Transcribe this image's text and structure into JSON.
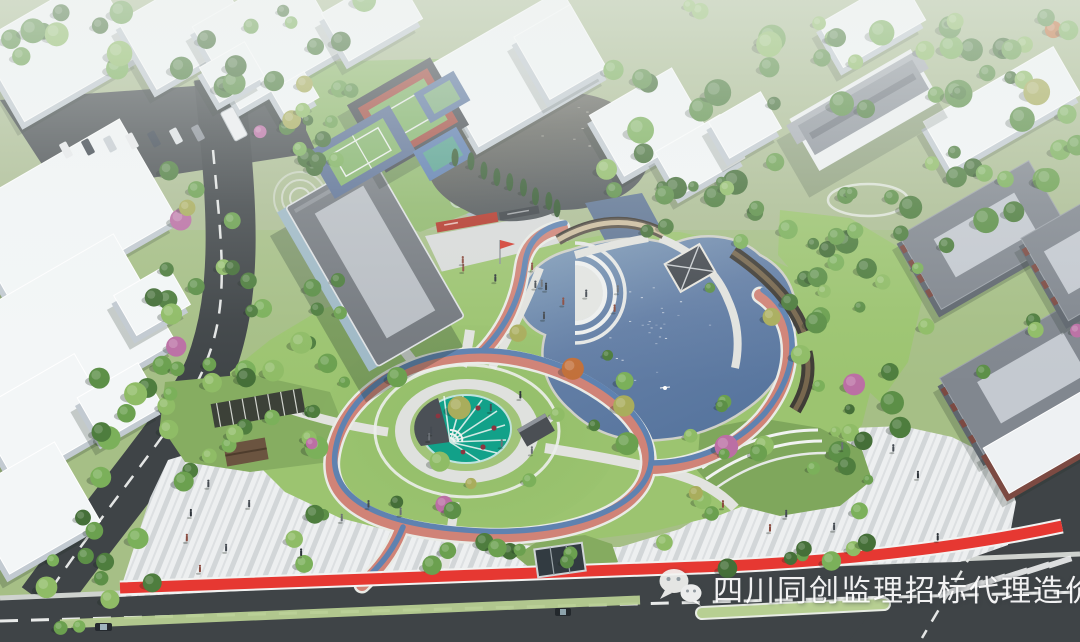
{
  "scene": {
    "description": "Bird's-eye architectural rendering of a park design: central lake with curved bridge and pavilion, circular teal fan-shaped plaza, red and blue jogging track, sports courts, large gray-roof hall with flag plaza, striped paving plaza with red accent band, surrounding roads, white campus buildings and dense trees"
  },
  "watermark": {
    "text": "四川同创监理招标代理造价",
    "icon": "wechat-icon",
    "color": "#ffffff"
  },
  "palette": {
    "grass": "#a6bf86",
    "grassBright": "#9cc470",
    "road": "#3f4447",
    "plazaA": "#eef0f1",
    "plazaB": "#d2d6d8",
    "lake1": "#84a0bb",
    "lake2": "#57759e",
    "pond1": "#6a685a",
    "pond2": "#4f5559",
    "trackRed": "#d08377",
    "trackBlue": "#5f82b0",
    "redBand": "#e63832",
    "teal": "#12a189",
    "roof": "#75797f",
    "haze": "#edf1ef"
  }
}
